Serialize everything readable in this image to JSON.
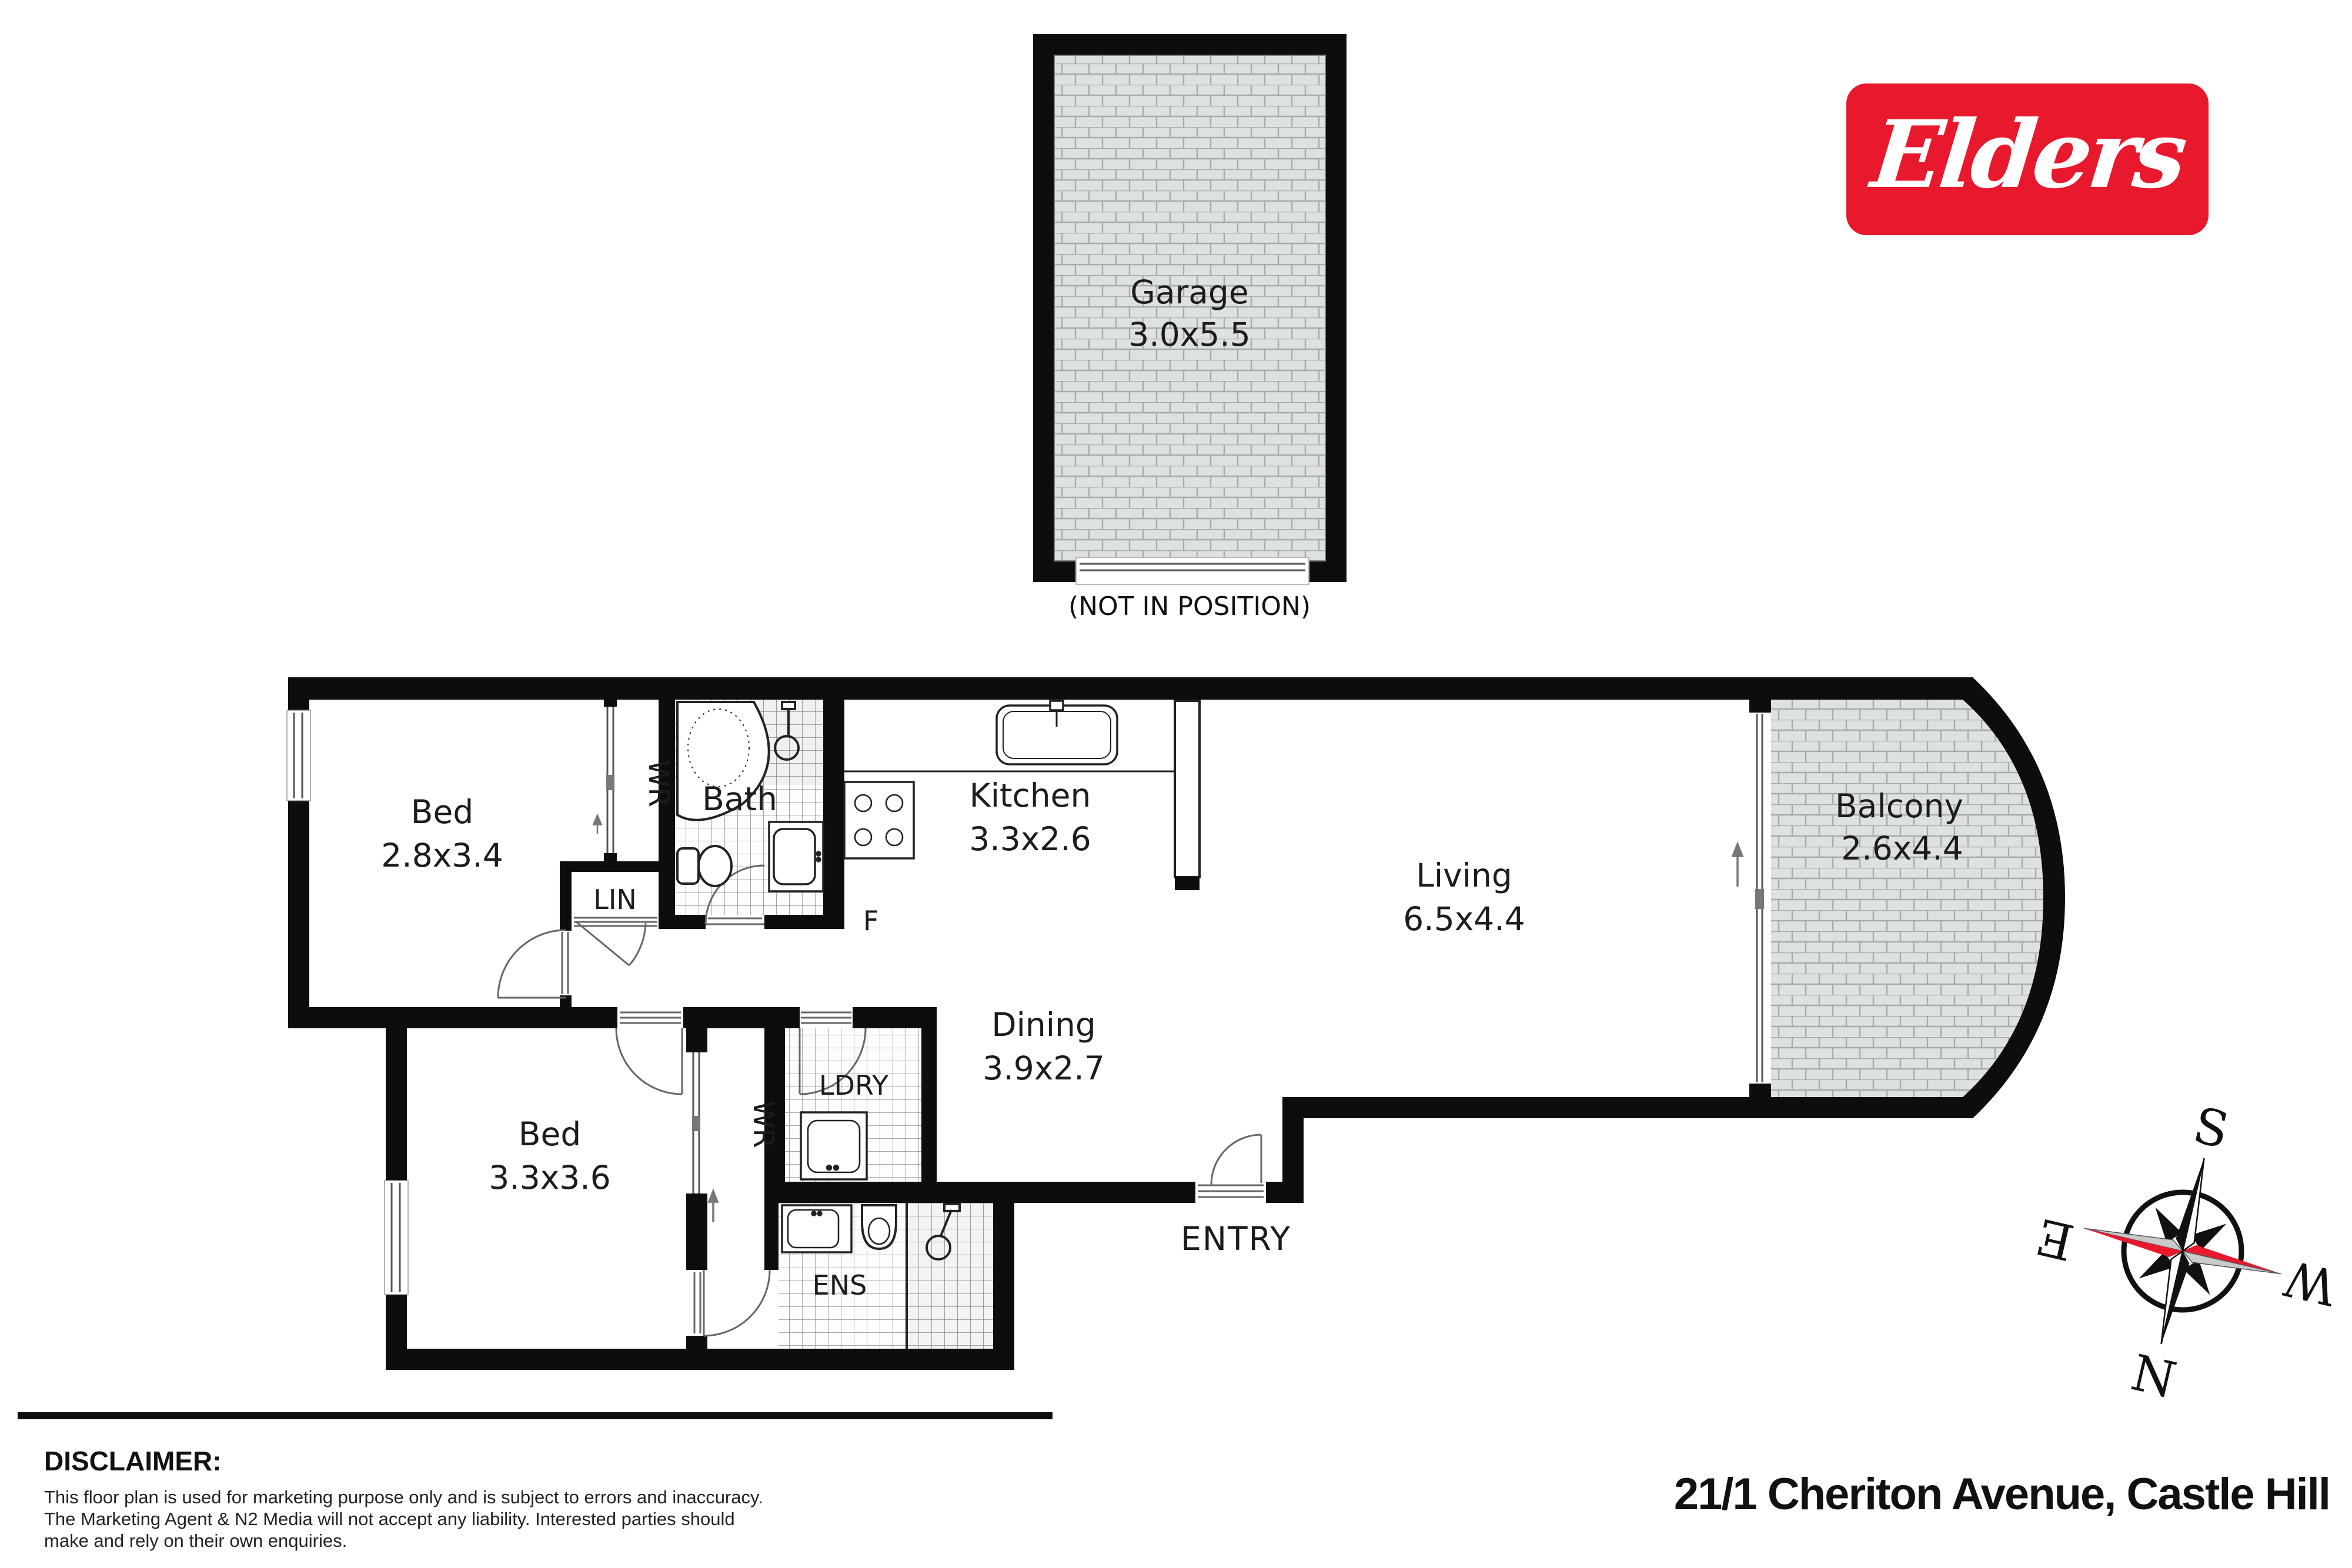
{
  "logo": {
    "brand": "Elders",
    "bg_color": "#e8192c"
  },
  "garage": {
    "name": "Garage",
    "dims": "3.0x5.5",
    "note": "(NOT IN POSITION)"
  },
  "rooms": {
    "bed1": {
      "name": "Bed",
      "dims": "2.8x3.4"
    },
    "bed2": {
      "name": "Bed",
      "dims": "3.3x3.6"
    },
    "bath": {
      "name": "Bath"
    },
    "kitchen": {
      "name": "Kitchen",
      "dims": "3.3x2.6"
    },
    "living": {
      "name": "Living",
      "dims": "6.5x4.4"
    },
    "dining": {
      "name": "Dining",
      "dims": "3.9x2.7"
    },
    "balcony": {
      "name": "Balcony",
      "dims": "2.6x4.4"
    },
    "laundry": {
      "name": "LDRY"
    },
    "ensuite": {
      "name": "ENS"
    },
    "linen": {
      "name": "LIN"
    },
    "wr1": {
      "name": "WR"
    },
    "wr2": {
      "name": "WR"
    },
    "fridge": {
      "name": "F"
    },
    "entry": {
      "name": "ENTRY"
    }
  },
  "compass": {
    "n": "N",
    "s": "S",
    "e": "E",
    "w": "W"
  },
  "footer": {
    "disclaimer_title": "DISCLAIMER:",
    "disclaimer_text": "This floor plan is used for marketing purpose only and is subject to errors and inaccuracy.\nThe Marketing Agent & N2 Media will not accept any liability. Interested parties should\nmake and rely on their own enquiries.",
    "address": "21/1 Cheriton Avenue, Castle Hill"
  }
}
